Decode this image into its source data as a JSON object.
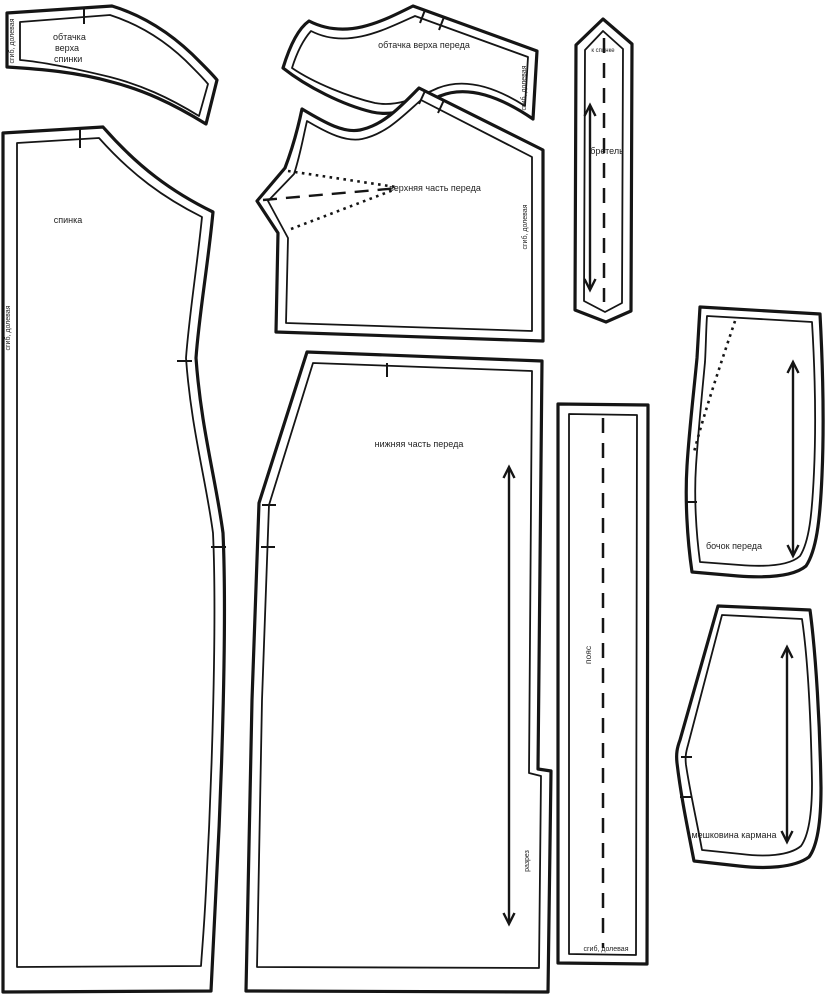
{
  "colors": {
    "background": "#ffffff",
    "line": "#151515",
    "text": "#1f1f1f"
  },
  "pieces": {
    "back_top_facing": {
      "label_line1": "обтачка",
      "label_line2": "верха",
      "label_line3": "спинки",
      "edge_text": "сгиб, долевая"
    },
    "front_top_facing": {
      "label": "обтачка верха переда",
      "edge_text": "сгиб, долевая"
    },
    "front_upper": {
      "label": "верхняя часть переда",
      "edge_text": "сгиб, долевая"
    },
    "back": {
      "label": "спинка",
      "edge_text": "сгиб, долевая"
    },
    "front_lower": {
      "label": "нижняя часть переда",
      "slit_text": "разрез"
    },
    "strap": {
      "label": "бретель",
      "top_text": "к спинке"
    },
    "belt": {
      "label": "пояс",
      "edge_text": "сгиб, долевая"
    },
    "front_side": {
      "label": "бочок переда"
    },
    "pocket_bag": {
      "label": "мешковина кармана"
    }
  }
}
